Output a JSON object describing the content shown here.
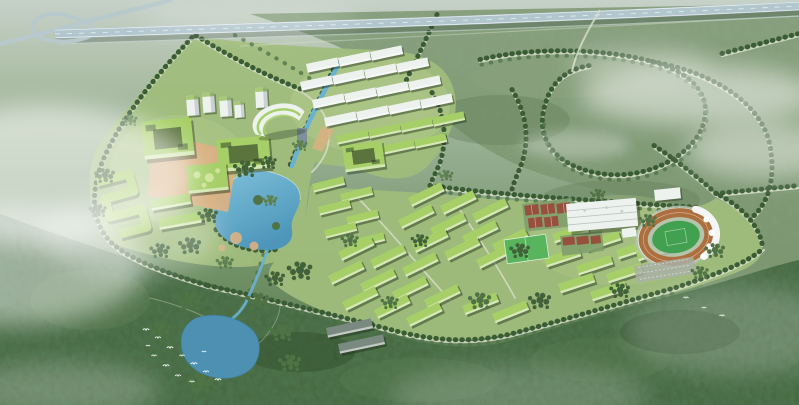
{
  "meta": {
    "alt_text": "Aerial bird's-eye architectural rendering of a green campus masterplan: an elevated highway with an interchange loop at the top left, green-roofed academic courtyard buildings and a curved landmark building around a lake on the west side, staggered rows of green-roofed dormitory blocks in the center, a stadium with running track, white gymnasium, red sports courts and parking on the east, all set in dense forest with winding tree-lined roads, a forest pond, flocks of white birds and drifting mist.",
    "view": "aerial oblique bird's-eye view",
    "style": "daytime, hazy architectural rendering"
  },
  "scene": {
    "landmarks": [
      "elevated-highway",
      "interchange-loop",
      "tree-lined-roads",
      "academic-courtyard-buildings",
      "curved-landmark-building",
      "white-academic-rows",
      "central-plaza",
      "campus-lake",
      "canal",
      "stream",
      "dormitory-rows",
      "stadium-running-track",
      "grandstand-tents",
      "gymnasium",
      "sports-courts",
      "practice-field",
      "parking-lot",
      "forest-belt",
      "forest-pond",
      "bird-flock",
      "mist-clouds"
    ]
  },
  "colors": {
    "bg_top": "#c6d1c8",
    "bg_upper": "#aebfa8",
    "bg_mid": "#90a98a",
    "bg_low": "#6f9065",
    "bg_bottom": "#4e7047",
    "olive": "#7d9671",
    "forest": "#47663e",
    "campus": "#a0bd7c",
    "campus_light": "#b6cd8e",
    "water_light": "#7fc0da",
    "water_deep": "#4d96ba",
    "pond": "#4d90b2",
    "canal": "#6ab2d2",
    "roof_green": "#a6cf67",
    "bldg_white": "#eef2ef",
    "dark_roof": "#7b8a80",
    "plaza_tan": "#d9b183",
    "highway": "#b2c6ce",
    "ramp": "#b7c9cc",
    "road_light": "#d8dec9",
    "tree_dark": "#3a5c35",
    "tree_mid": "#51744a",
    "grove_a": "#40613a",
    "grove_b": "#4f7344",
    "grove_c": "#5d8050",
    "track_orange": "#ad6f3e",
    "pitch_green": "#42a150",
    "pitch_light": "#58b55e",
    "court_red": "#97503d",
    "parking_gray": "#a8b0a4",
    "concrete": "#b9c4b4",
    "mist": "#ffffff",
    "bird": "#f4f8f4"
  }
}
